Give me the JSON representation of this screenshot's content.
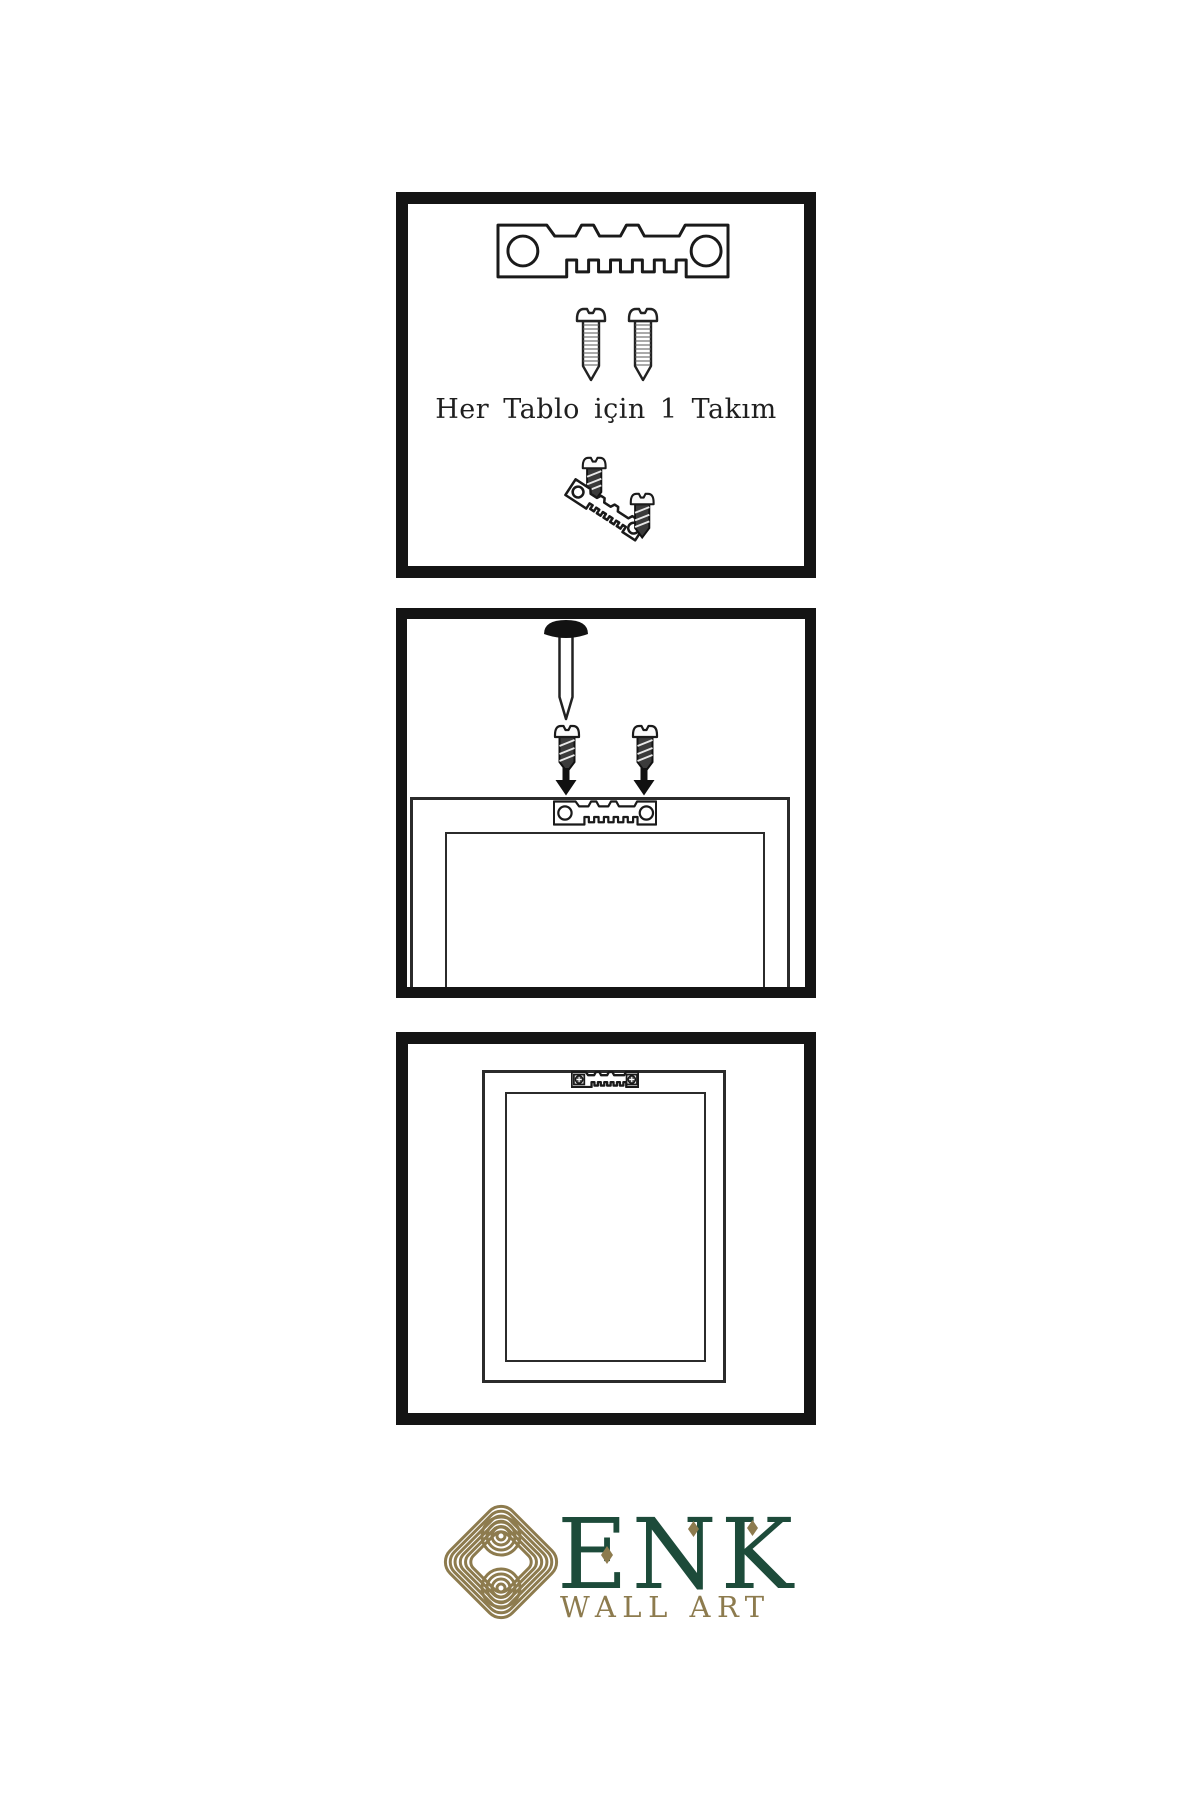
{
  "canvas": {
    "width": 1200,
    "height": 1800,
    "background": "#ffffff"
  },
  "panel_hardware_kit": {
    "caption": "Her Tablo için 1 Takım"
  },
  "logo": {
    "brand": "ENK",
    "subtitle": "WALL ART",
    "colors": {
      "green": "#1d4b3a",
      "gold": "#8d7b4e"
    }
  },
  "colors": {
    "ink": "#1a1a1a",
    "panel_border": "#141414",
    "screw_dark": "#3b3b3b"
  },
  "icons": {
    "sawtooth_hanger": "metal plate with sawtooth teeth and two holes",
    "screw": "round-head screw side view",
    "nail": "wall nail with dome head",
    "arrow_down": "solid downward arrow",
    "knot_emblem": "interlaced gold knot"
  }
}
